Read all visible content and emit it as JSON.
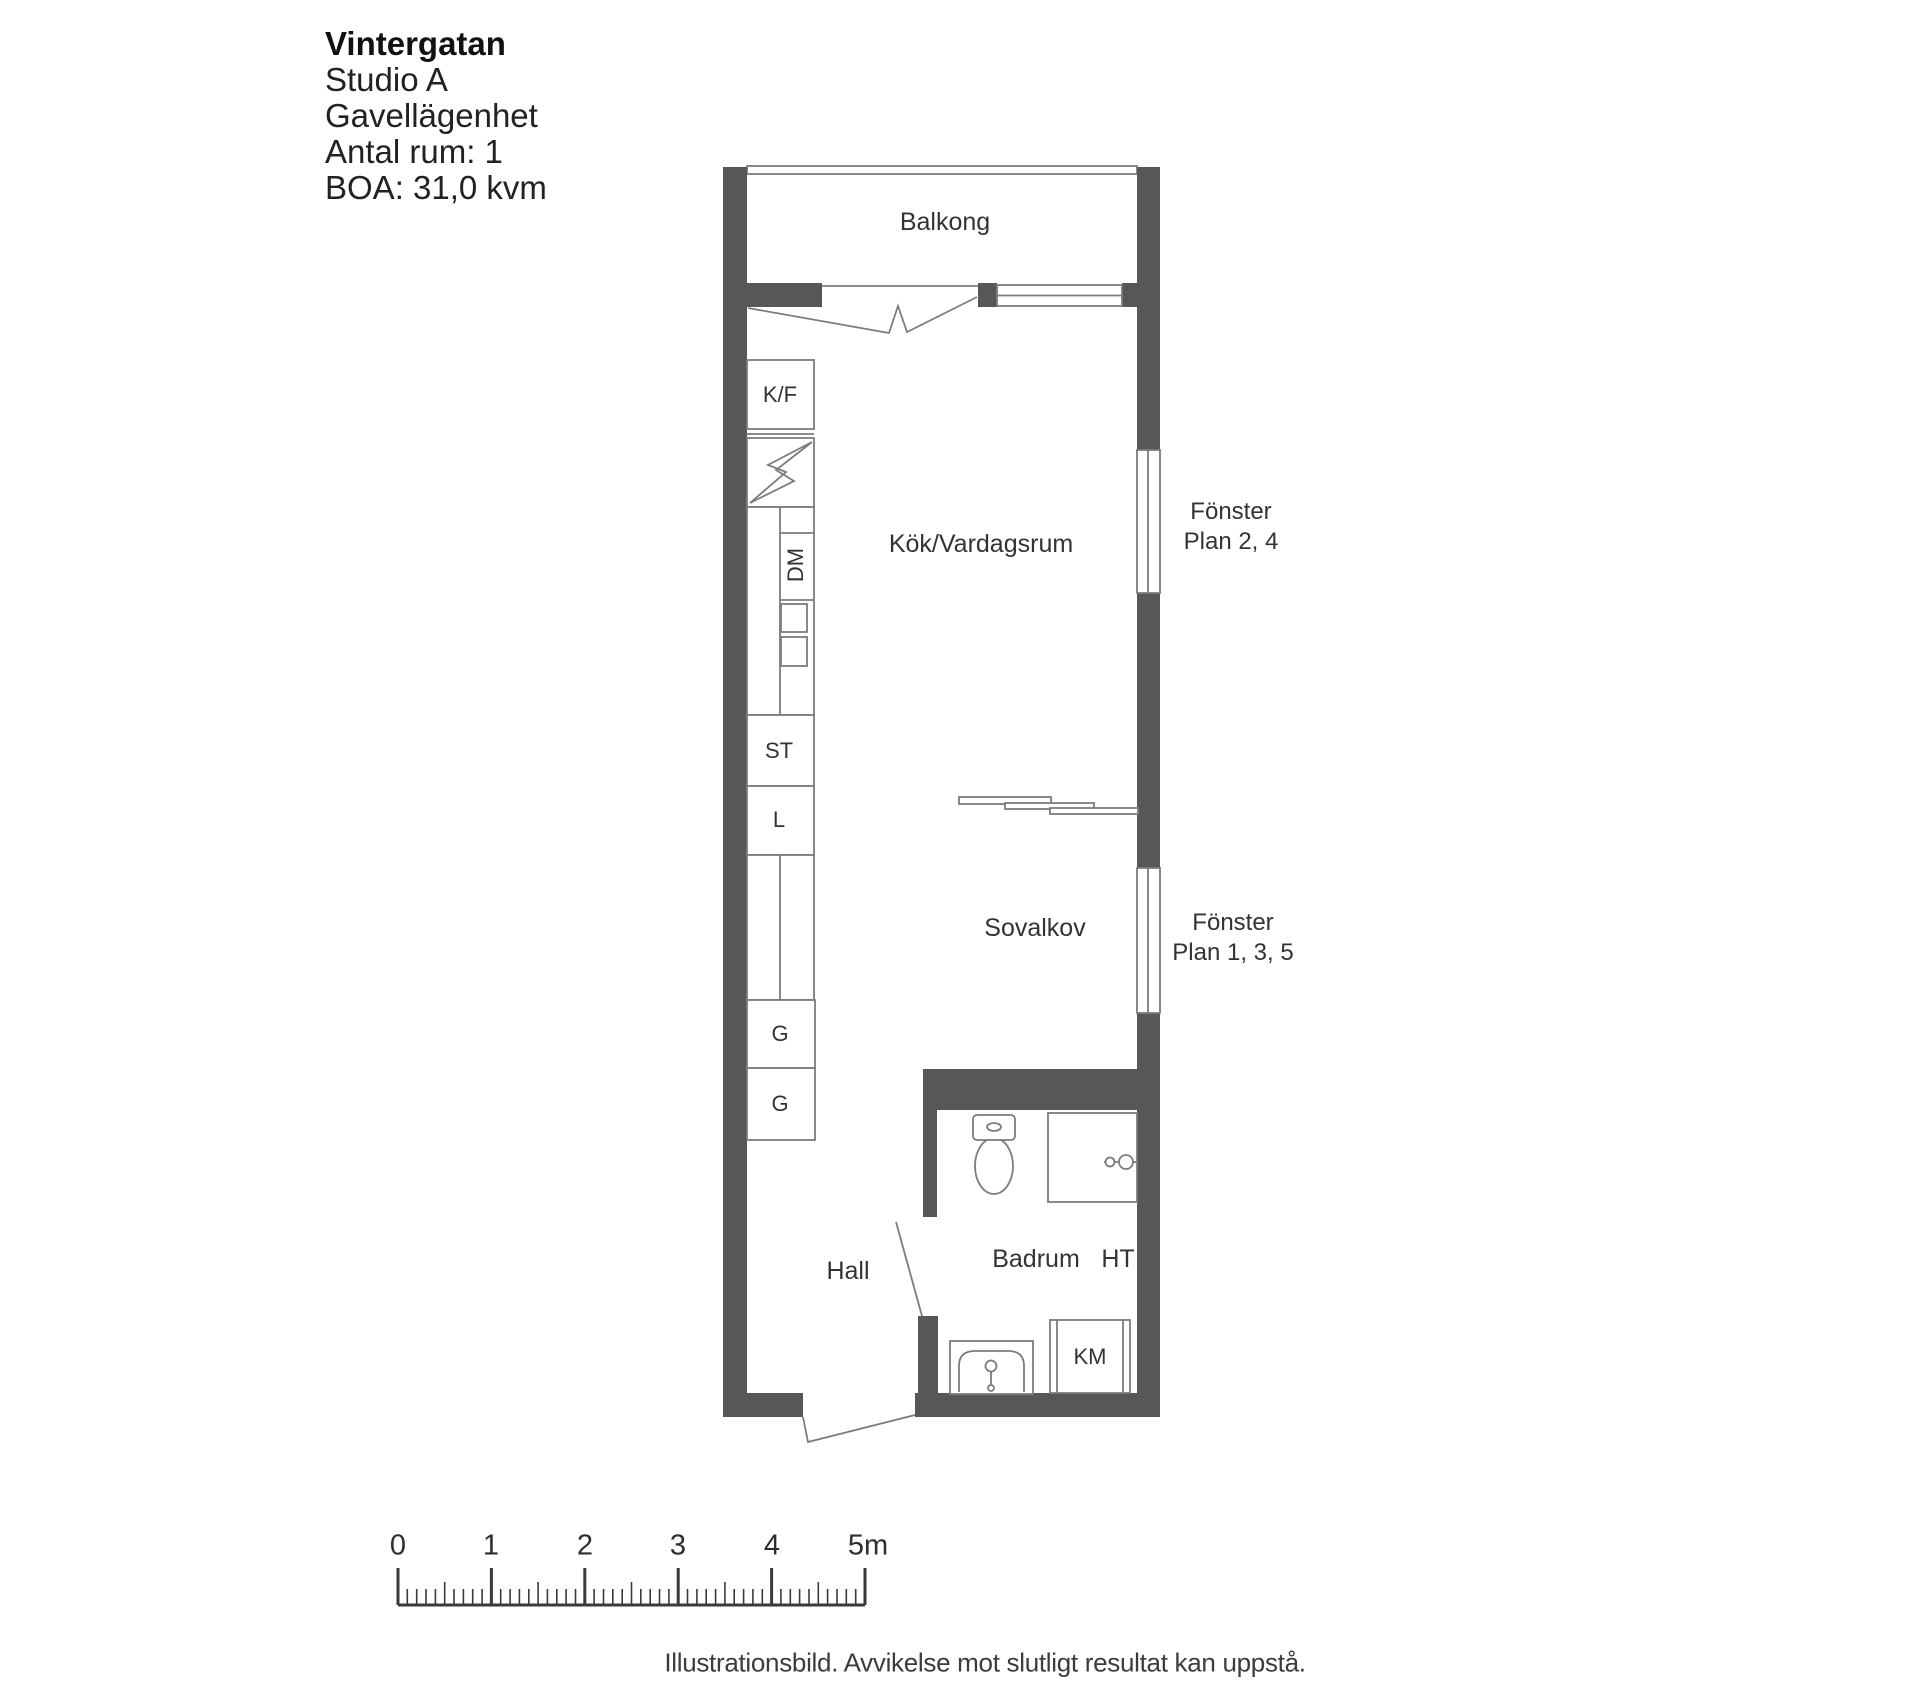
{
  "header": {
    "title": "Vintergatan",
    "line2": "Studio A",
    "line3": "Gavellägenhet",
    "line4": "Antal rum: 1",
    "line5": "BOA: 31,0 kvm"
  },
  "rooms": {
    "balcony": "Balkong",
    "kitchen_living": "Kök/Vardagsrum",
    "sleeping_alcove": "Sovalkov",
    "hall": "Hall",
    "bathroom": "Badrum"
  },
  "fixtures": {
    "fridge_freezer": "K/F",
    "dishwasher": "DM",
    "cleaning_cabinet": "ST",
    "linen_cabinet": "L",
    "wardrobe_top": "G",
    "wardrobe_bottom": "G",
    "towel_dryer": "HT",
    "washing_machine": "KM"
  },
  "window_notes": {
    "upper": {
      "line1": "Fönster",
      "line2": "Plan 2, 4"
    },
    "lower": {
      "line1": "Fönster",
      "line2": "Plan 1, 3, 5"
    }
  },
  "scale_bar": {
    "labels": [
      "0",
      "1",
      "2",
      "3",
      "4",
      "5m"
    ]
  },
  "caption": "Illustrationsbild. Avvikelse mot slutligt resultat kan uppstå.",
  "colors": {
    "wall": "#57575a",
    "line": "#7c7c7c",
    "text": "#333333"
  }
}
